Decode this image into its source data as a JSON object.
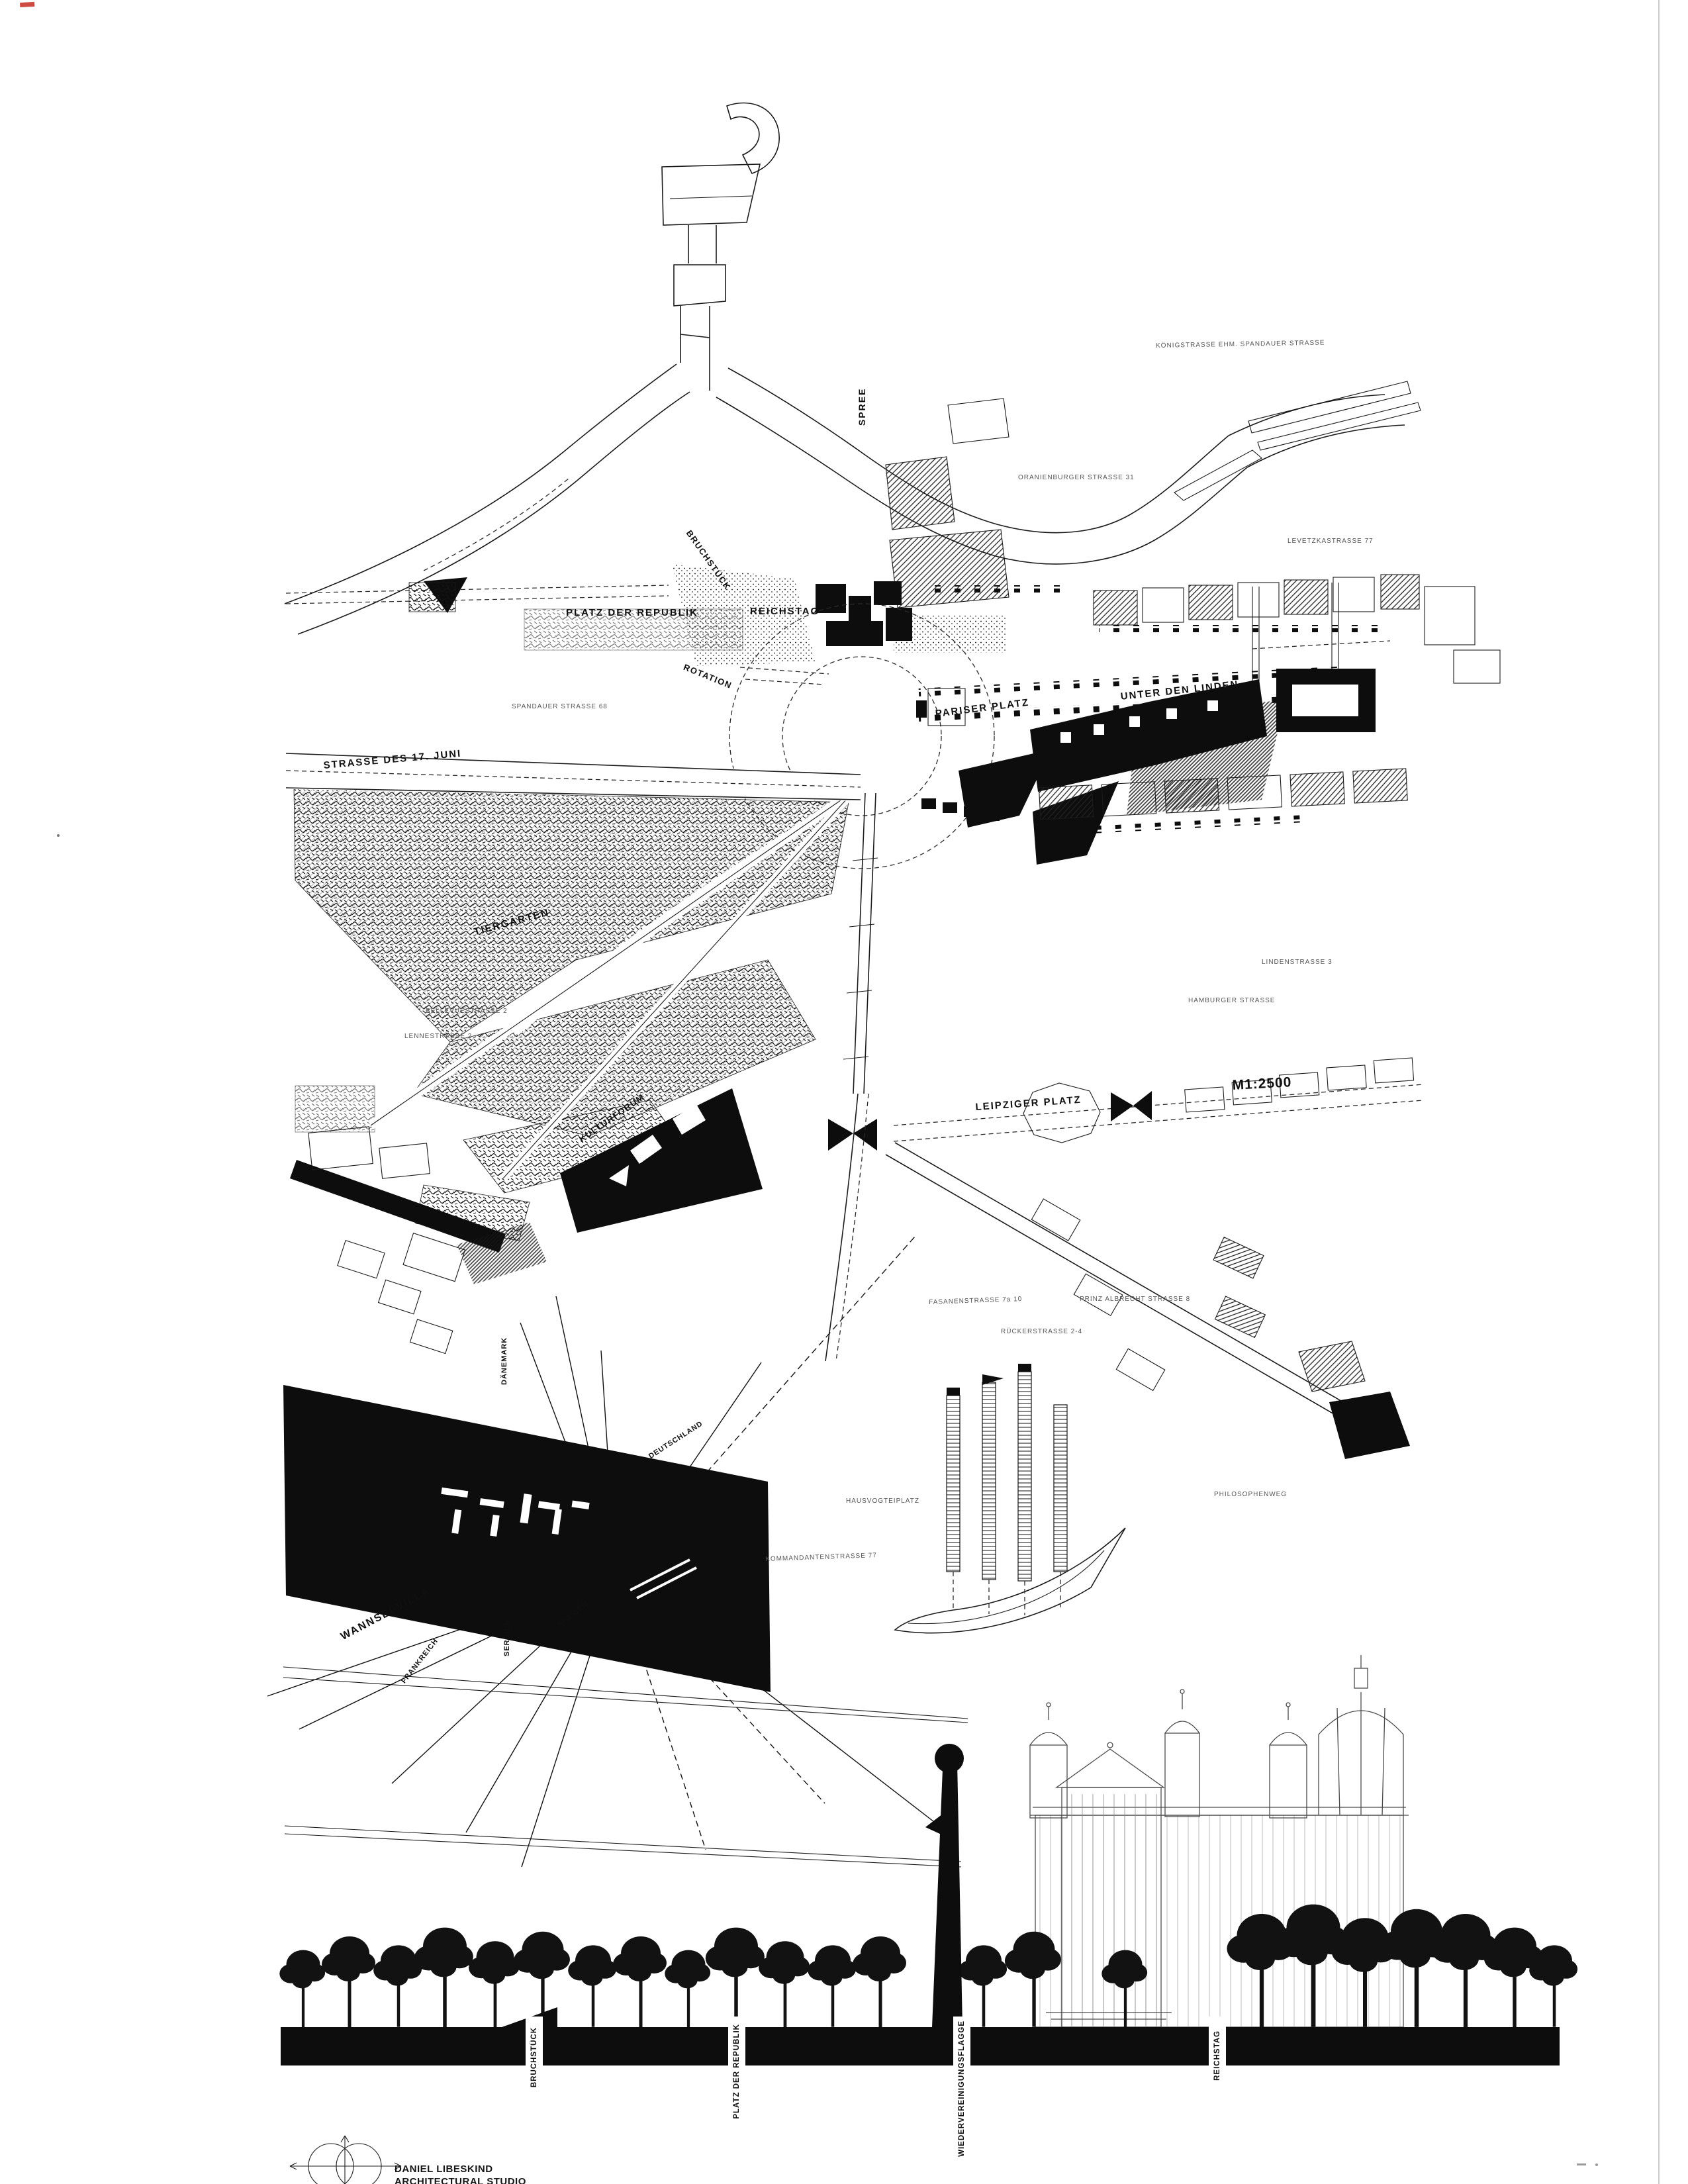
{
  "map": {
    "labels": {
      "koenigstrasse": "KÖNIGSTRASSE EHM. SPANDAUER STRASSE",
      "spree": "SPREE",
      "oranienburger": "ORANIENBURGER STRASSE 31",
      "levetzka": "LEVETZKASTRASSE 77",
      "platz_der_republik": "PLATZ DER REPUBLIK",
      "reichstag": "REICHSTAG",
      "bruchstueck": "BRUCHSTÜCK",
      "rotation": "ROTATION",
      "spandauer": "SPANDAUER STRASSE 68",
      "pariser_platz": "PARISER PLATZ",
      "unter_den_linden": "UNTER DEN LINDEN",
      "strasse_17_juni": "STRASSE DES 17. JUNI",
      "tiergarten": "TIERGARTEN",
      "bellevuestrasse": "BELLEVUESTRASSE 2",
      "lennestrasse": "LENNESTRASSE 2",
      "lindenstrasse": "LINDENSTRASSE 3",
      "hamburger_strasse": "HAMBURGER STRASSE",
      "scale": "M1:2500",
      "leipziger_platz": "LEIPZIGER PLATZ",
      "kulturforum": "KULTURFORUM",
      "fasanenstrasse": "FASANENSTRASSE 7a 10",
      "prinz_albrecht": "PRINZ ALBRECHT STRASSE 8",
      "rueckerstrasse": "RÜCKERSTRASSE 2-4",
      "hausvogteiplatz": "HAUSVOGTEIPLATZ",
      "kommandantenstrasse": "KOMMANDANTENSTRASSE 77",
      "philosophenweg": "PHILOSOPHENWEG",
      "daenemark": "DÄNEMARK",
      "deutschland": "DEUTSCHLAND",
      "wannseevilla": "WANNSEEVILLA",
      "frankreich": "FRANKREICH",
      "serbien": "SERBIEN",
      "spanien": "SPANIEN"
    }
  },
  "section": {
    "tags": {
      "bruchstueck": "BRUCHSTÜCK",
      "platz_der_republik": "PLATZ DER REPUBLIK",
      "wiedervereinigungsflagge": "WIEDERVEREINIGUNGSFLAGGE",
      "reichstag": "REICHSTAG"
    }
  },
  "credit": {
    "line1": "DANIEL LIBESKIND",
    "line2": "ARCHITECTURAL STUDIO"
  },
  "icons": {
    "compass": "compass-rose"
  },
  "colors": {
    "ink": "#111111",
    "paper": "#ffffff",
    "red_mark": "#c8372d"
  }
}
